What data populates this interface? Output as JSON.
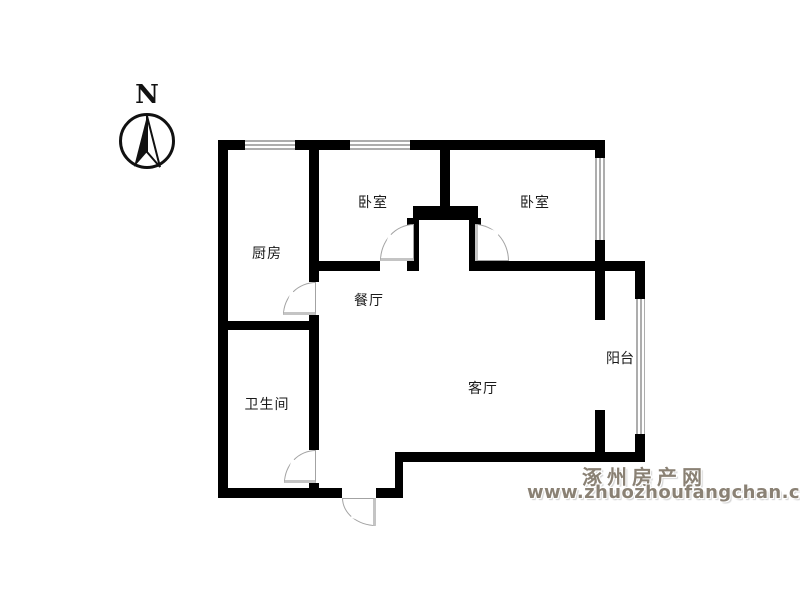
{
  "compass": {
    "north_label": "N"
  },
  "rooms": {
    "kitchen": {
      "label": "厨房"
    },
    "bedroom_left": {
      "label": "卧室"
    },
    "bedroom_right": {
      "label": "卧室"
    },
    "dining": {
      "label": "餐厅"
    },
    "bathroom": {
      "label": "卫生间"
    },
    "living": {
      "label": "客厅"
    },
    "balcony": {
      "label": "阳台"
    }
  },
  "watermark": {
    "site_name": "涿州房产网",
    "site_url": "www.zhuozhoufangchan.com"
  },
  "colors": {
    "wall": "#000000",
    "window_line": "#adadad",
    "door_line": "#a3a3a3",
    "door_panel": "#c4c4c4",
    "watermark": "#8a8174",
    "background": "#ffffff"
  }
}
